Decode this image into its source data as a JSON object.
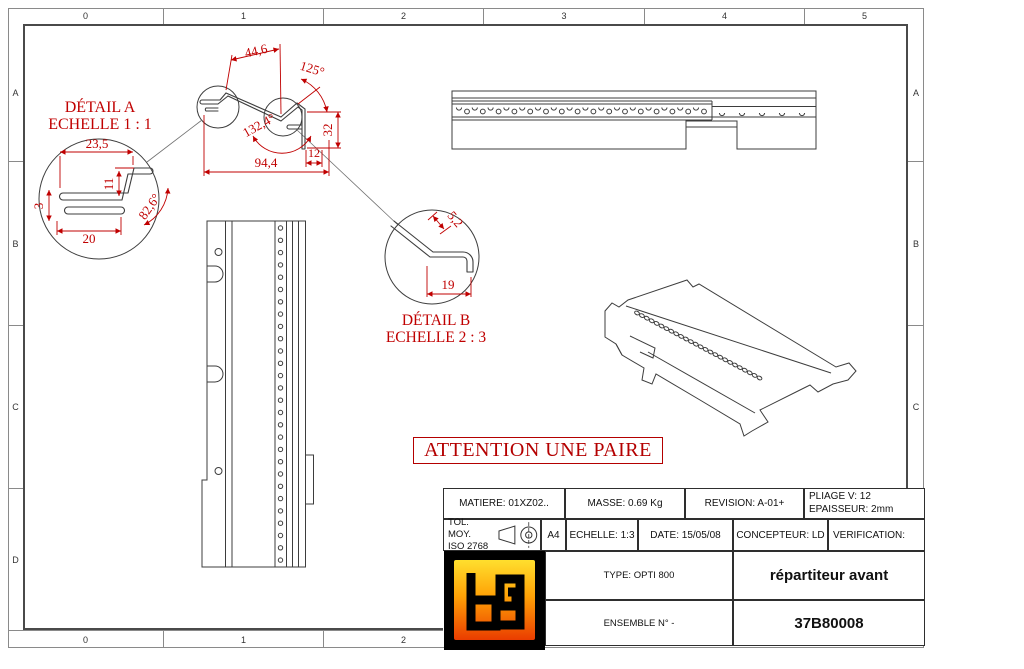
{
  "colors": {
    "annotation_red": "#c00000",
    "line_gray": "#3d3d3d",
    "logo_yellow": "#ffdf2e",
    "logo_orange": "#ffa206",
    "logo_red": "#ea3c00"
  },
  "grid": {
    "top": [
      "0",
      "1",
      "2",
      "3",
      "4",
      "5"
    ],
    "bottom": [
      "0",
      "1",
      "2"
    ],
    "left": [
      "A",
      "B",
      "C",
      "D"
    ],
    "right": [
      "A",
      "B",
      "C",
      "D"
    ]
  },
  "detail_a": {
    "title": "DÉTAIL A",
    "scale": "ECHELLE 1 : 1",
    "dim_width_top": "23,5",
    "dim_height": "11",
    "dim_thickness": "3",
    "dim_width_bottom": "20",
    "dim_angle": "82,6°"
  },
  "detail_b": {
    "title": "DÉTAIL B",
    "scale": "ECHELLE 2 : 3",
    "dim_flange": "5,2",
    "dim_width": "19"
  },
  "profile": {
    "dim_top": "44,6",
    "dim_angle_right": "125°",
    "dim_angle_left": "132,4°",
    "dim_overall": "94,4",
    "dim_foot": "12",
    "dim_height": "32"
  },
  "attention_note": "ATTENTION UNE PAIRE",
  "title_block": {
    "matiere": "MATIERE: 01XZ02..",
    "masse": "MASSE: 0.69 Kg",
    "revision": "REVISION: A-01+",
    "pliage": "PLIAGE V: 12",
    "epaisseur": "EPAISSEUR: 2mm",
    "tol_line1": "TOL. MOY.",
    "tol_line2": "ISO 2768",
    "format": "A4",
    "echelle": "ECHELLE: 1:3",
    "date": "DATE: 15/05/08",
    "concepteur": "CONCEPTEUR: LD",
    "verification": "VERIFICATION:",
    "type": "TYPE: OPTI 800",
    "designation": "répartiteur avant",
    "ensemble": "ENSEMBLE N° -",
    "number": "37B80008",
    "logo_text": "bg"
  }
}
